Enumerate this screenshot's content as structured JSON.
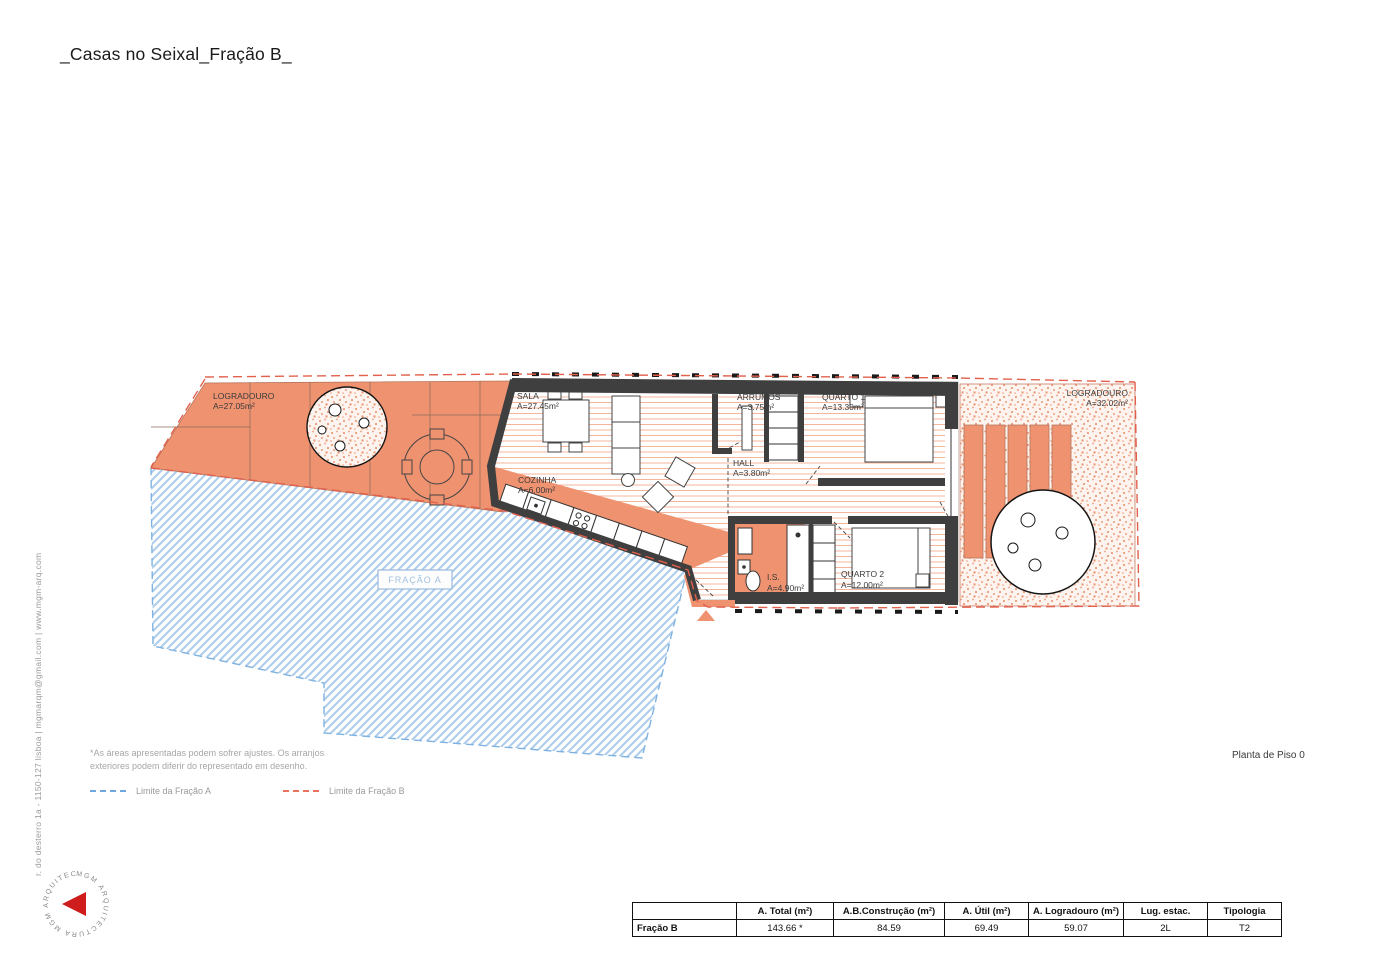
{
  "title": "_Casas no Seixal_Fração B_",
  "drawing_label": "Planta de Piso 0",
  "firm": {
    "address_line": "r. do desterro 1a - 1150-127 lisboa | mgmarqm@gmail.com | www.mgm-arq.com",
    "logo_ring_text": "MGM ARQUITECTURA   MGM ARQUITECTURA"
  },
  "notes": {
    "line1": "*As áreas apresentadas podem sofrer ajustes. Os arranjos",
    "line2": "exteriores podem diferir do representado em desenho."
  },
  "legend": {
    "items": [
      {
        "label": "Limite da Fração A",
        "color": "#6fa8dc"
      },
      {
        "label": "Limite da Fração B",
        "color": "#e8705c"
      }
    ]
  },
  "plan": {
    "fracao_a_label": "FRAÇÃO A",
    "rooms": {
      "logradouro_left": {
        "name": "LOGRADOURO",
        "area": "A=27.05m²"
      },
      "sala": {
        "name": "SALA",
        "area": "A=27.45m²"
      },
      "cozinha": {
        "name": "COZINHA",
        "area": "A=6.00m²"
      },
      "arrumos": {
        "name": "ARRUMOS",
        "area": "A=3.75m²"
      },
      "quarto1": {
        "name": "QUARTO 1",
        "area": "A=13.30m²"
      },
      "hall": {
        "name": "HALL",
        "area": "A=3.80m²"
      },
      "is": {
        "name": "I.S.",
        "area": "A=4.90m²"
      },
      "quarto2": {
        "name": "QUARTO 2",
        "area": "A=12.00m²"
      },
      "logradouro_right": {
        "name": "LOGRADOURO",
        "area": "A=32.02m²"
      }
    }
  },
  "table": {
    "headers": [
      "",
      "A. Total (m²)",
      "A.B.Construção (m²)",
      "A. Útil (m²)",
      "A. Logradouro (m²)",
      "Lug. estac.",
      "Tipologia"
    ],
    "rows": [
      {
        "label": "Fração B",
        "total": "143.66 *",
        "construcao": "84.59",
        "util": "69.49",
        "logradouro": "59.07",
        "estac": "2L",
        "tipologia": "T2"
      }
    ]
  },
  "colors": {
    "fracao_b_fill": "#ef9270",
    "fracao_a_hatch": "#aecdeb",
    "limit_a": "#6fa8dc",
    "limit_b": "#e2604c",
    "wall": "#3f3f3f",
    "logo_red": "#cf1d1d"
  }
}
